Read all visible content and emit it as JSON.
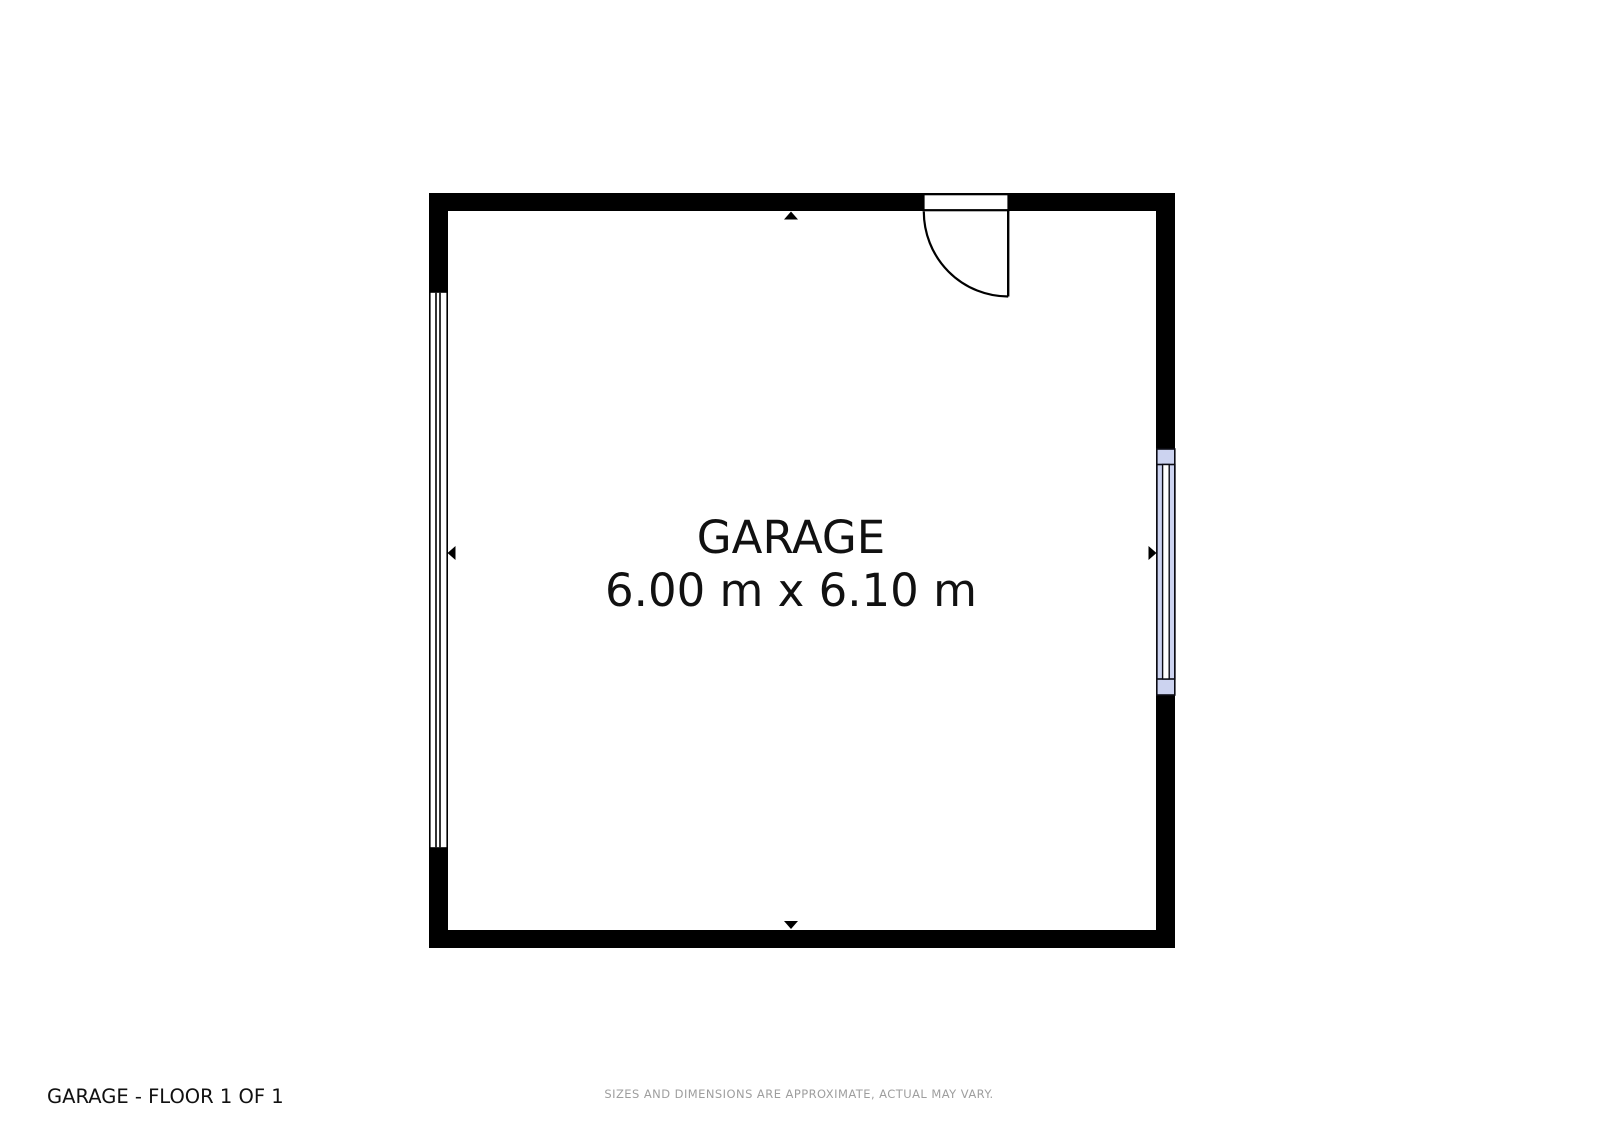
{
  "room": {
    "name": "GARAGE",
    "dimensions": "6.00 m x 6.10 m"
  },
  "footer": {
    "left_label": "GARAGE - FLOOR 1 OF 1",
    "disclaimer": "SIZES AND DIMENSIONS ARE APPROXIMATE, ACTUAL MAY VARY."
  },
  "colors": {
    "wall": "#000000",
    "window_glass": "#ccd3f0",
    "background": "#ffffff",
    "text": "#111111",
    "disclaimer": "#9e9e9e"
  }
}
